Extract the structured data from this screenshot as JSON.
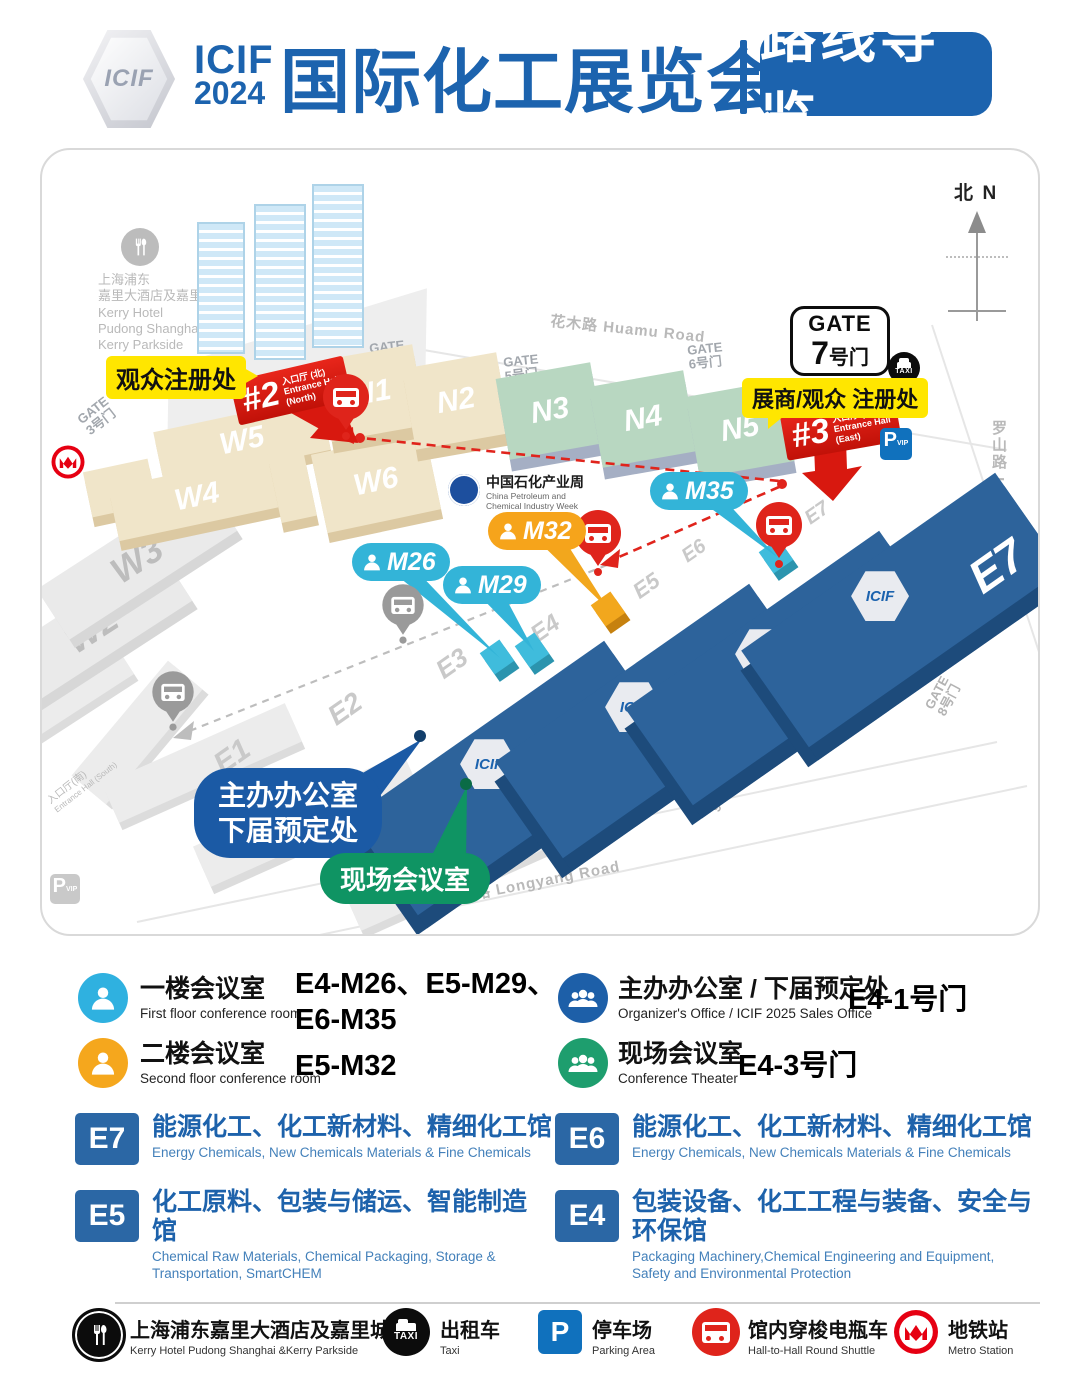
{
  "colors": {
    "brand_blue": "#1c63ae",
    "hall_blue": "#2d639b",
    "accent_red": "#df241b",
    "callout_yellow": "#ffe600",
    "marker_cyan": "#33b4d8",
    "marker_orange": "#f6a41b",
    "bubble_green": "#0f9463",
    "bubble_blue": "#1b5aa5"
  },
  "header": {
    "hex_label": "ICIF",
    "brand_line1": "ICIF",
    "brand_line2": "2024",
    "title": "国际化工展览会",
    "badge": "路线导览"
  },
  "map": {
    "compass": {
      "cn": "北",
      "en": "N"
    },
    "roads": {
      "huamu": "花木路  Huamu Road",
      "luoshan": "罗山路  Luoshan Road",
      "longyang": "龙阳路  Longyang Road"
    },
    "gates": {
      "g3": {
        "l1": "GATE",
        "l2": "3号门"
      },
      "g4": {
        "l1": "GATE",
        "l2": "4号门"
      },
      "g5": {
        "l1": "GATE",
        "l2": "5号门"
      },
      "g6": {
        "l1": "GATE",
        "l2": "6号门"
      },
      "g7": {
        "l1": "GATE",
        "num": "7",
        "suffix": "号门"
      },
      "g8": {
        "l1": "GATE",
        "l2": "8号门"
      },
      "g9": {
        "l1": "GATE",
        "l2": "9号门"
      }
    },
    "kerry": {
      "k1": "上海浦东",
      "k2": "嘉里大酒店及嘉里城",
      "k3": "Kerry Hotel",
      "k4": "Pudong Shanghai &",
      "k5": "Kerry Parkside"
    },
    "halls": {
      "w2": "W2",
      "w3": "W3",
      "w4": "W4",
      "w5": "W5",
      "w6": "W6",
      "n1": "N1",
      "n2": "N2",
      "n3": "N3",
      "n4": "N4",
      "n5": "N5",
      "e4": "E4",
      "e5": "E5",
      "e6": "E6",
      "e7": "E7"
    },
    "corridors": {
      "c1": "E1",
      "c2": "E2",
      "c3": "E3",
      "c4": "E4",
      "c5": "E5",
      "c6": "E6",
      "c7": "E7"
    },
    "icif_hex": "ICIF",
    "entrance2": {
      "num": "#2",
      "cn": "入口厅 (北)",
      "en1": "Entrance Hall",
      "en2": "(North)"
    },
    "entrance3": {
      "num": "#3",
      "cn": "入口厅 (东)",
      "en1": "Entrance Hall",
      "en2": "(East)"
    },
    "entrance_south": {
      "cn": "入口厅(南)",
      "en": "Entrance Hall (South)"
    },
    "callouts": {
      "visitor": "观众注册处",
      "exhibitor": "展商/观众 注册处"
    },
    "bubbles": {
      "organizer1": "主办办公室",
      "organizer2": "下届预定处",
      "conference": "现场会议室"
    },
    "markers": {
      "m26": "M26",
      "m29": "M29",
      "m32": "M32",
      "m35": "M35"
    },
    "cpciw": {
      "cn": "中国石化产业周",
      "en1": "China Petroleum and",
      "en2": "Chemical Industry Week"
    },
    "pvip": {
      "p": "P",
      "vip": "VIP"
    },
    "taxi_label": "TAXI"
  },
  "legend": {
    "rows": [
      {
        "cn": "一楼会议室",
        "en": "First floor conference room",
        "value_l1": "E4-M26、E5-M29、",
        "value_l2": "E6-M35"
      },
      {
        "cn": "二楼会议室",
        "en": "Second floor conference room",
        "value_l1": "E5-M32",
        "value_l2": ""
      },
      {
        "cn": "主办办公室 / 下届预定处",
        "en": "Organizer's Office / ICIF 2025 Sales Office",
        "value_l1": "E4-1号门",
        "value_l2": ""
      },
      {
        "cn": "现场会议室",
        "en": "Conference Theater",
        "value_l1": "E4-3号门",
        "value_l2": ""
      }
    ]
  },
  "hall_info": [
    {
      "code": "E7",
      "cn": "能源化工、化工新材料、精细化工馆",
      "en": "Energy Chemicals, New Chemicals Materials & Fine Chemicals"
    },
    {
      "code": "E6",
      "cn": "能源化工、化工新材料、精细化工馆",
      "en": "Energy Chemicals, New Chemicals Materials & Fine Chemicals"
    },
    {
      "code": "E5",
      "cn": "化工原料、包装与储运、智能制造馆",
      "en": "Chemical Raw Materials, Chemical Packaging, Storage & Transportation, SmartCHEM"
    },
    {
      "code": "E4",
      "cn": "包装设备、化工工程与装备、安全与环保馆",
      "en": "Packaging Machinery,Chemical Engineering and Equipment, Safety and Environmental Protection"
    }
  ],
  "footer": [
    {
      "cn": "上海浦东嘉里大酒店及嘉里城",
      "en": "Kerry Hotel Pudong Shanghai &Kerry Parkside"
    },
    {
      "cn": "出租车",
      "en": "Taxi"
    },
    {
      "cn": "停车场",
      "en": "Parking Area"
    },
    {
      "cn": "馆内穿梭电瓶车",
      "en": "Hall-to-Hall Round Shuttle"
    },
    {
      "cn": "地铁站",
      "en": "Metro Station"
    }
  ]
}
